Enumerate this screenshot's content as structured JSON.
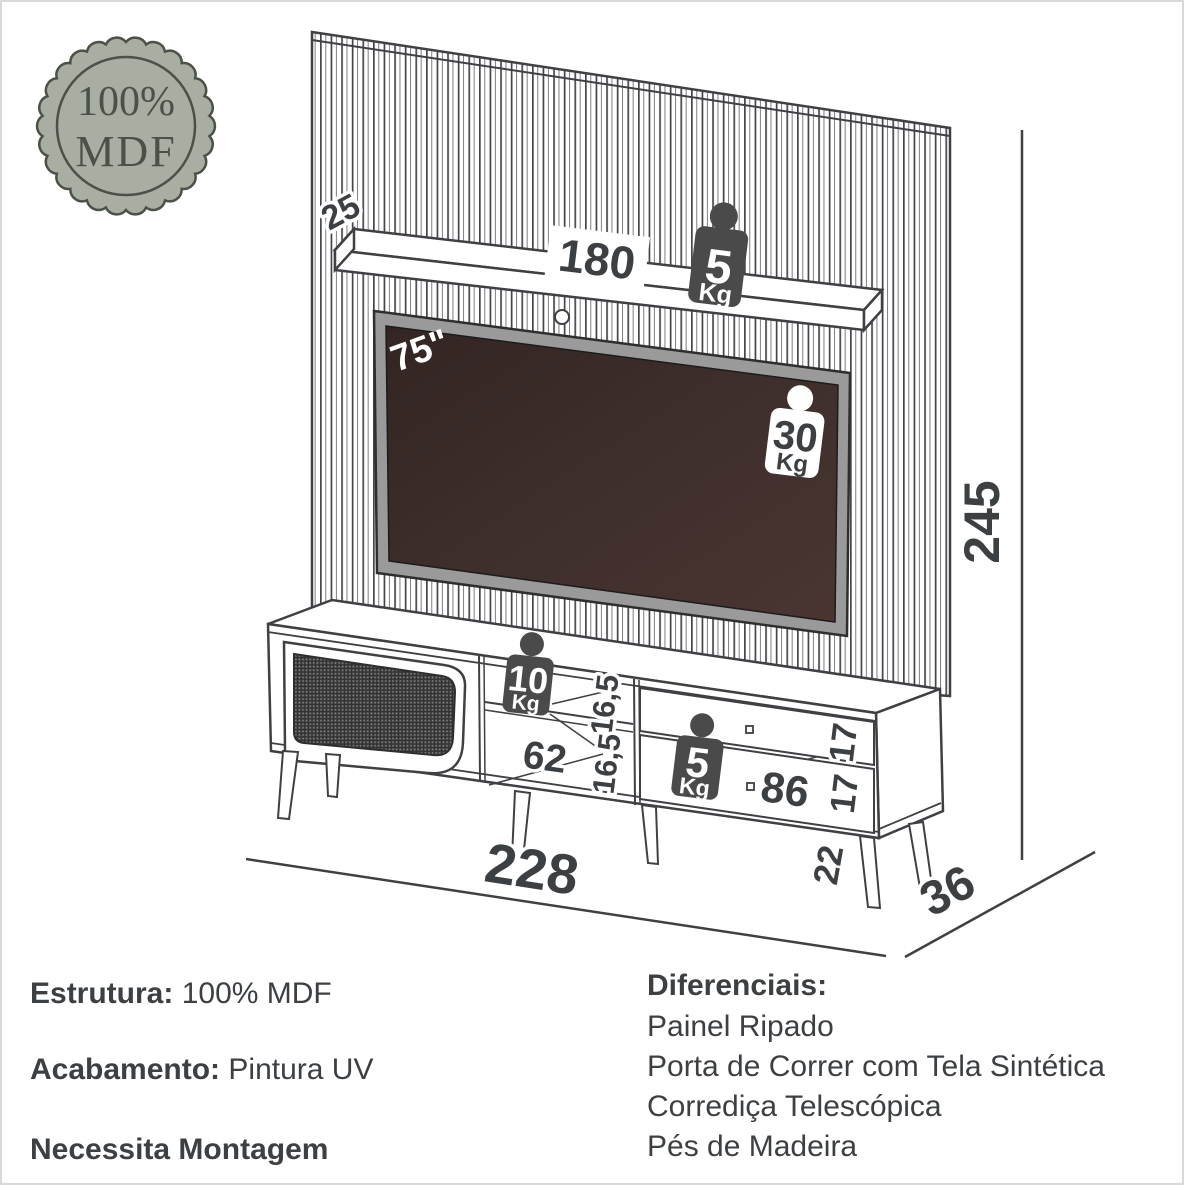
{
  "badge": {
    "line1": "100%",
    "line2": "MDF"
  },
  "diagram": {
    "dimensions": {
      "shelf_depth": "25",
      "shelf_width": "180",
      "tv_size": "75\"",
      "total_height": "245",
      "niche_height_top": "16,5",
      "niche_height_bottom": "16,5",
      "niche_width": "62",
      "drawer_height_top": "17",
      "drawer_height_bottom": "17",
      "drawer_width": "86",
      "leg_height": "22",
      "total_width": "228",
      "total_depth": "36"
    },
    "weights": {
      "shelf": {
        "value": "5",
        "unit": "Kg"
      },
      "tv": {
        "value": "30",
        "unit": "Kg"
      },
      "niche": {
        "value": "10",
        "unit": "Kg"
      },
      "drawer": {
        "value": "5",
        "unit": "Kg"
      }
    }
  },
  "specs": {
    "estrutura": {
      "label": "Estrutura:",
      "value": "100% MDF"
    },
    "acabamento": {
      "label": "Acabamento:",
      "value": "Pintura UV"
    },
    "montagem": {
      "label": "Necessita Montagem"
    },
    "diferenciais": {
      "title": "Diferenciais:",
      "items": [
        "Painel Ripado",
        "Porta de Correr com Tela Sintética",
        "Corrediça Telescópica",
        "Pés de Madeira"
      ]
    }
  },
  "colors": {
    "line": "#3f4043",
    "badge_fill": "#a8aea1",
    "badge_ink": "#4b5147",
    "weight_dark": "#4a4a4a",
    "tv_screen": "#40302e",
    "tv_frame": "#9a9a9a"
  }
}
